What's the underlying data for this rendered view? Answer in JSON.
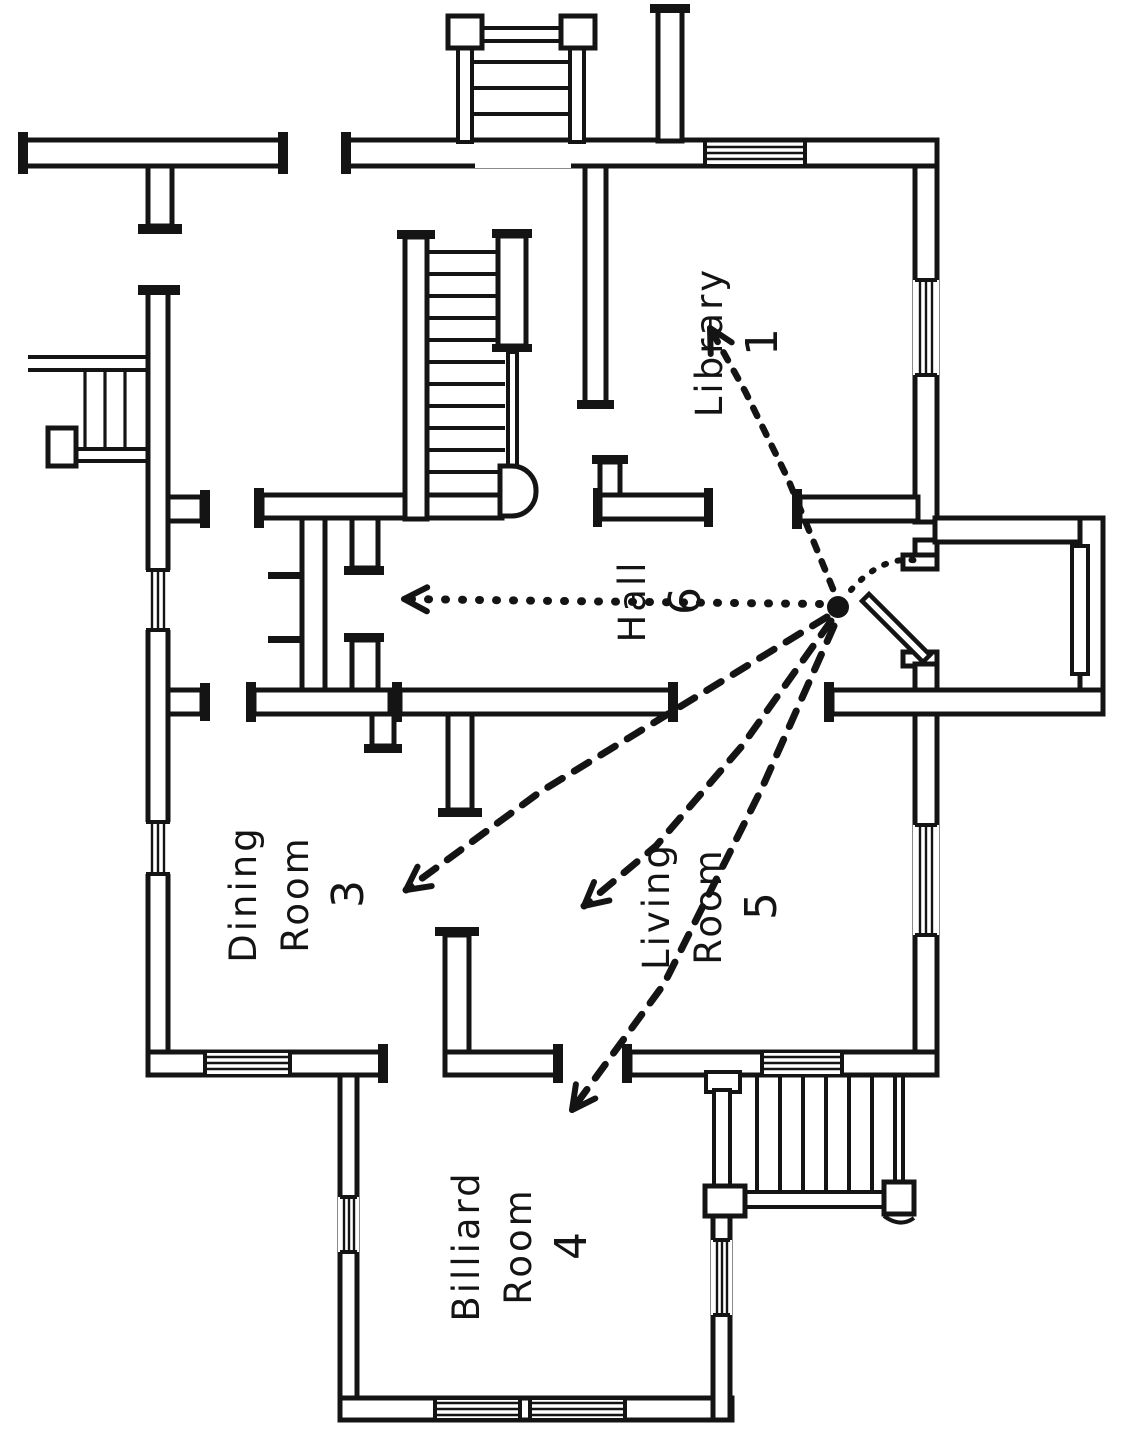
{
  "figure": {
    "kind": "house first-floor plan (hand-drawn)",
    "paper_color": "#ffffff",
    "ink_color": "#141414"
  },
  "rooms": [
    {
      "id": "library",
      "label": "Library",
      "number": "1"
    },
    {
      "id": "hall",
      "label": "Hall",
      "number": "6"
    },
    {
      "id": "dining-room",
      "label": "Dining\nRoom",
      "number": "3"
    },
    {
      "id": "living-room",
      "label": "Living\nRoom",
      "number": "5"
    },
    {
      "id": "billiard-room",
      "label": "Billiard\nRoom",
      "number": "4"
    }
  ],
  "annotations": {
    "origin_dot": {
      "x": 838,
      "y": 607,
      "r": 11
    },
    "arrows": [
      {
        "to": "hall",
        "style": "dot",
        "arrow": true,
        "points": [
          [
            820,
            604
          ],
          [
            560,
            601
          ],
          [
            404,
            599
          ]
        ]
      },
      {
        "to": "library",
        "style": "dotsmall",
        "arrow": true,
        "points": [
          [
            833,
            589
          ],
          [
            788,
            479
          ],
          [
            745,
            391
          ],
          [
            710,
            328
          ]
        ]
      },
      {
        "to": "dining-room",
        "style": "dash",
        "arrow": true,
        "points": [
          [
            827,
            617
          ],
          [
            696,
            697
          ],
          [
            540,
            792
          ],
          [
            406,
            890
          ]
        ]
      },
      {
        "to": "living-room",
        "style": "dash",
        "arrow": true,
        "points": [
          [
            831,
            621
          ],
          [
            742,
            746
          ],
          [
            656,
            846
          ],
          [
            584,
            906
          ]
        ]
      },
      {
        "to": "billiard-room",
        "style": "dash",
        "arrow": true,
        "points": [
          [
            834,
            626
          ],
          [
            762,
            788
          ],
          [
            664,
            984
          ],
          [
            572,
            1110
          ]
        ]
      }
    ]
  }
}
